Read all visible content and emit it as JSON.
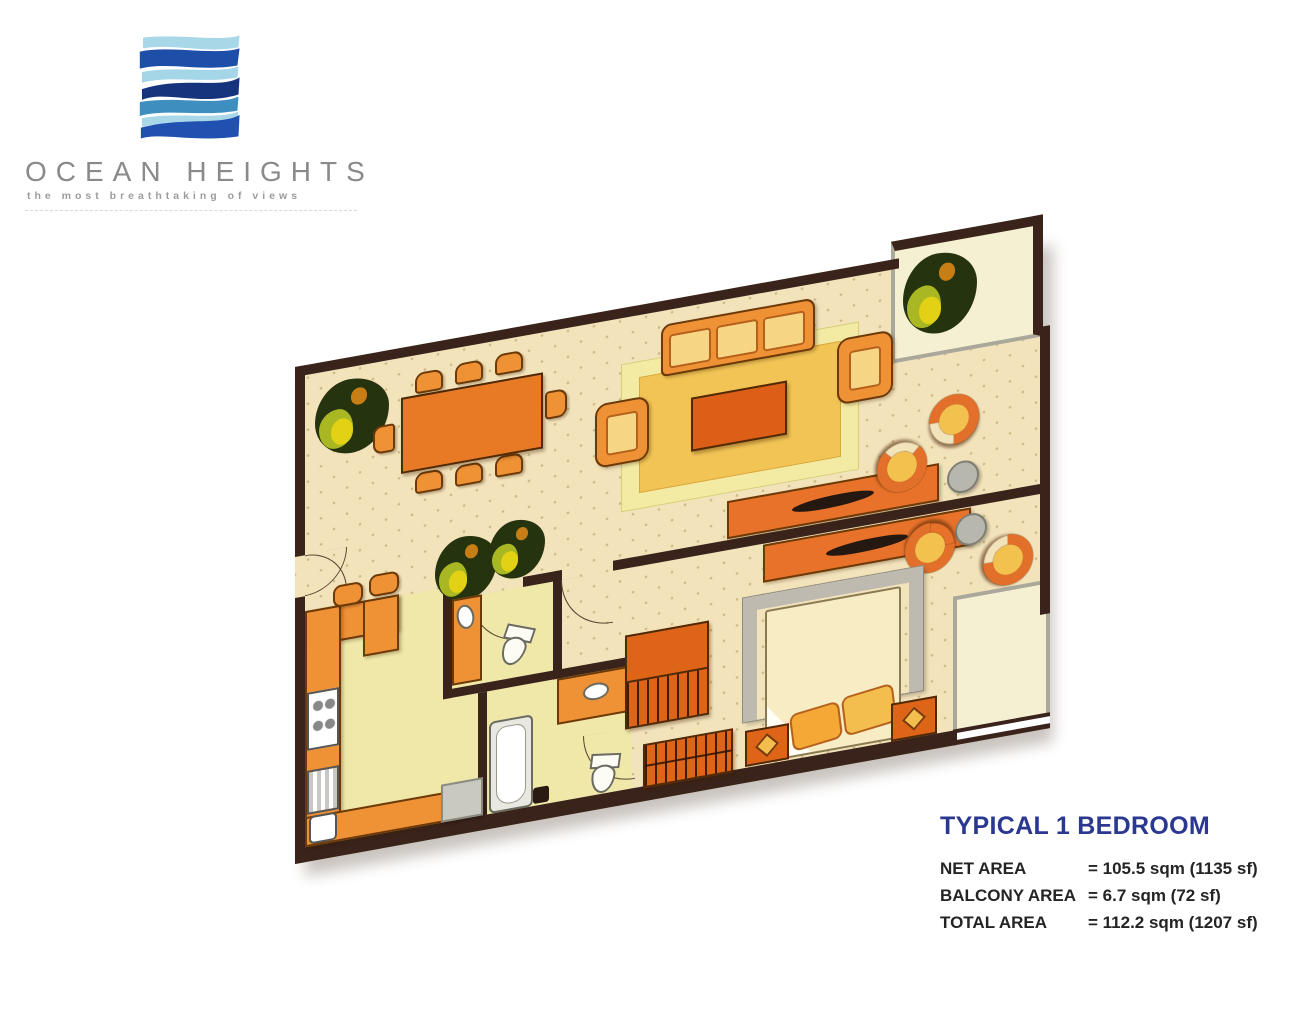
{
  "brand": {
    "name": "OCEAN HEIGHTS",
    "tagline": "the most breathtaking of views",
    "logo_icon": "wave-logo-icon",
    "logo_colors": [
      "#A8D8E8",
      "#1E4FA8",
      "#A5D6E8",
      "#16337E",
      "#3E8FC0",
      "#2050B0"
    ]
  },
  "plan": {
    "type": "floor-plan",
    "unit": "1 bedroom apartment",
    "colors": {
      "wall": "#3A231B",
      "floor": "#F3E3BB",
      "wet_area_floor": "#EFE8A8",
      "furniture_orange": "#EF9135",
      "furniture_dark_orange": "#DE6418",
      "rug_gold": "#F2C455",
      "rug_pale": "#F3EBA4",
      "balcony_floor": "#F6F0D2",
      "gray": "#B7B7AE"
    }
  },
  "info": {
    "title": "TYPICAL 1 BEDROOM",
    "title_color": "#2B3890",
    "rows": [
      {
        "label": "NET AREA",
        "value": "= 105.5 sqm (1135 sf)"
      },
      {
        "label": "BALCONY AREA",
        "value": "= 6.7 sqm (72 sf)"
      },
      {
        "label": "TOTAL AREA",
        "value": "= 112.2 sqm (1207 sf)"
      }
    ]
  }
}
